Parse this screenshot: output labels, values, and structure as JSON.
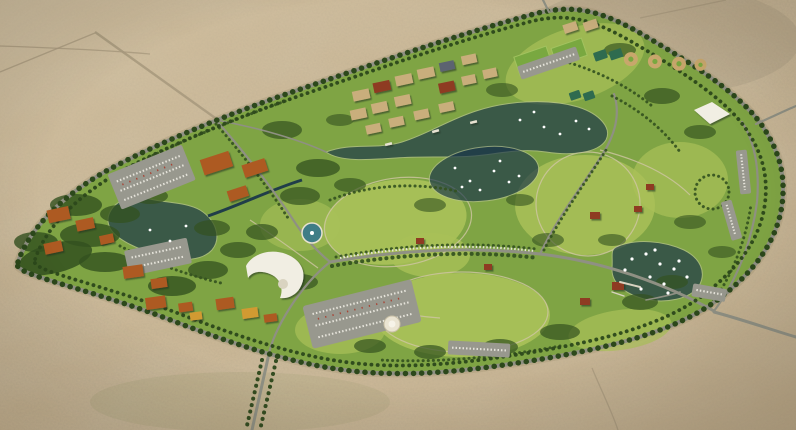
{
  "meta": {
    "title": "Aerial rendering of a palm-ringed desert park master plan",
    "width": 796,
    "height": 430
  },
  "colors": {
    "desert_base": "#c9b695",
    "desert_track": "#a99a7e",
    "park_green": "#7fa444",
    "lawn_light": "#a9c158",
    "tree_dark": "#33511f",
    "palm_green": "#2c481b",
    "road_grey": "#8f9083",
    "sand_path": "#cfc6a4",
    "water": "#16324a",
    "boat_white": "#ffffff",
    "roof_tan": "#c9ae7b",
    "roof_orange": "#ad5a20",
    "roof_red": "#8e3b24",
    "roof_slate": "#5b6471",
    "roof_yellow": "#d19a33",
    "parking_grey": "#98988e",
    "canopy_white": "#f1eee3",
    "monument_white": "#eae4d2",
    "fountain_teal": "#3f7d86",
    "court_green": "#2f6b4f",
    "field_green": "#79a840",
    "diamond_tan": "#c8a76c"
  },
  "scene": {
    "terrain": "open desert scrub with faint tracks",
    "park": {
      "shape": "large elliptical green oasis",
      "perimeter": "palm-lined loop road",
      "entrances": [
        "northwest",
        "north",
        "east",
        "southeast",
        "south"
      ]
    },
    "water": {
      "lakes": [
        "west-lake",
        "village-canal",
        "upper-lake",
        "round-lake",
        "east-lake"
      ],
      "boats": "small white boats on all lakes",
      "piers": [
        "east-lake-pier"
      ]
    },
    "structures": {
      "village": "canal-side grid of tan and red roofed buildings",
      "clusters": [
        "northwest-lodges",
        "west-pavilions",
        "southwest-cottages",
        "south-cottages",
        "east-pavilions",
        "marina-house"
      ],
      "landmarks": [
        "amphitheater-canopy",
        "east-canopy",
        "fountain-plaza",
        "white-monument",
        "tree-circle"
      ]
    },
    "recreation": {
      "sports": [
        "soccer-fields",
        "tennis-courts",
        "baseball-diamonds"
      ],
      "parking_lots": 8,
      "lawns": "large rolling meadows with walking loops"
    }
  }
}
